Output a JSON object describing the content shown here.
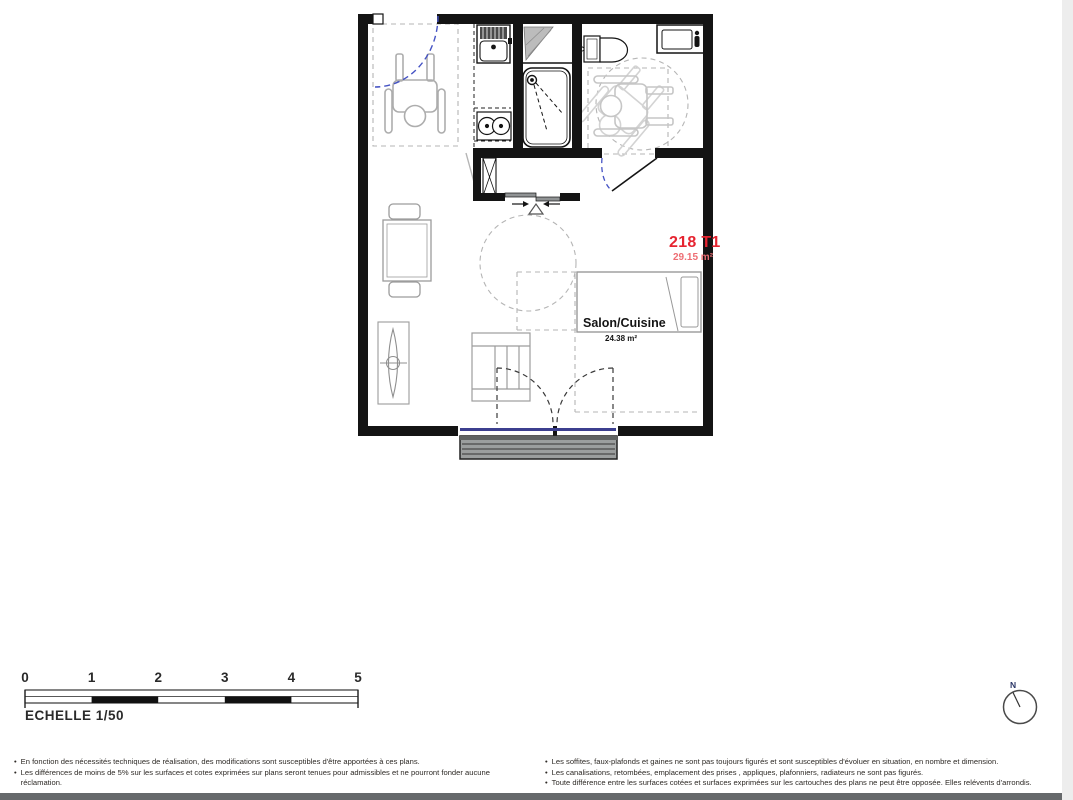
{
  "plan": {
    "unit_label": "218 T1",
    "unit_area": "29.15 m²",
    "room_label": "Salon/Cuisine",
    "room_area": "24.38 m²",
    "colors": {
      "unit_red": "#e62430",
      "area_red": "#ee6e74",
      "wall_black": "#141414",
      "door_blue": "#4553c4",
      "glazing_blue": "#3c3f8f",
      "symbol_gray": "#b0b0b0",
      "balcony_gray": "#9b9e9e"
    }
  },
  "scalebar": {
    "ticks": [
      "0",
      "1",
      "2",
      "3",
      "4",
      "5"
    ],
    "label": "ECHELLE 1/50"
  },
  "compass": {
    "north_label": "N"
  },
  "footer": {
    "left_notes": [
      "En fonction des nécessités techniques de réalisation, des modifications sont susceptibles d'être apportées à ces plans.",
      "Les différences de moins de 5% sur les surfaces et cotes exprimées sur plans seront tenues pour admissibles et ne pourront fonder aucune réclamation."
    ],
    "right_notes": [
      "Les soffites, faux-plafonds et gaines ne sont pas toujours figurés et sont susceptibles d'évoluer en situation, en nombre et dimension.",
      "Les canalisations, retombées, emplacement des prises , appliques, plafonniers, radiateurs ne sont pas figurés.",
      "Toute différence entre les surfaces cotées et surfaces exprimées sur les cartouches des plans ne peut être opposée. Elles relévents d'arrondis."
    ]
  }
}
